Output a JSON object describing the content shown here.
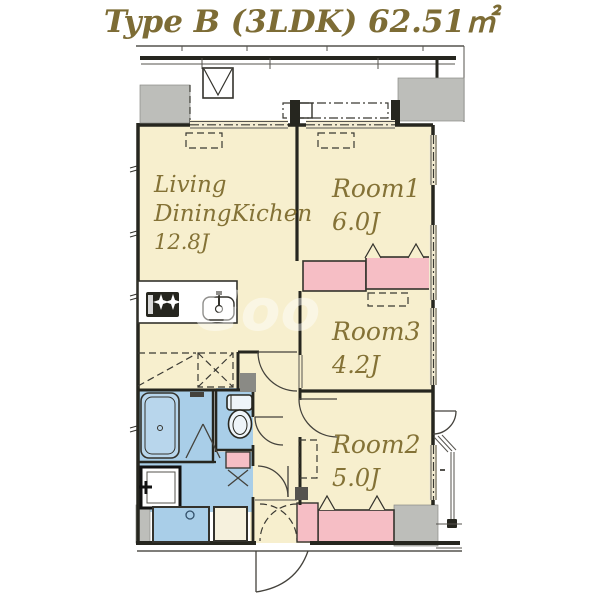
{
  "title": "Type B (3LDK) 62.51㎡",
  "watermark": "Goo",
  "rooms": {
    "ldk": {
      "line1": "Living",
      "line2": "DiningKichen",
      "size": "12.8J"
    },
    "room1": {
      "name": "Room1",
      "size": "6.0J"
    },
    "room3": {
      "name": "Room3",
      "size": "4.2J"
    },
    "room2": {
      "name": "Room2",
      "size": "5.0J"
    }
  },
  "fixtures": {
    "bathtub": "bathtub-icon",
    "toilet": "toilet-icon",
    "stove": "stove-burners-icon",
    "kitchen_sink": "kitchen-sink-icon",
    "washing_machine": "washing-machine-pan-icon",
    "vanity": "vanity-unit-icon",
    "meter_box": "meter-box-icon"
  },
  "colors": {
    "room_cream": "#f7efce",
    "closet_pink": "#f6bec5",
    "wet_area_blue": "#a9cee8",
    "exterior_gray": "#bdbeba",
    "wall_dark": "#26261f",
    "label_olive": "#847236"
  }
}
